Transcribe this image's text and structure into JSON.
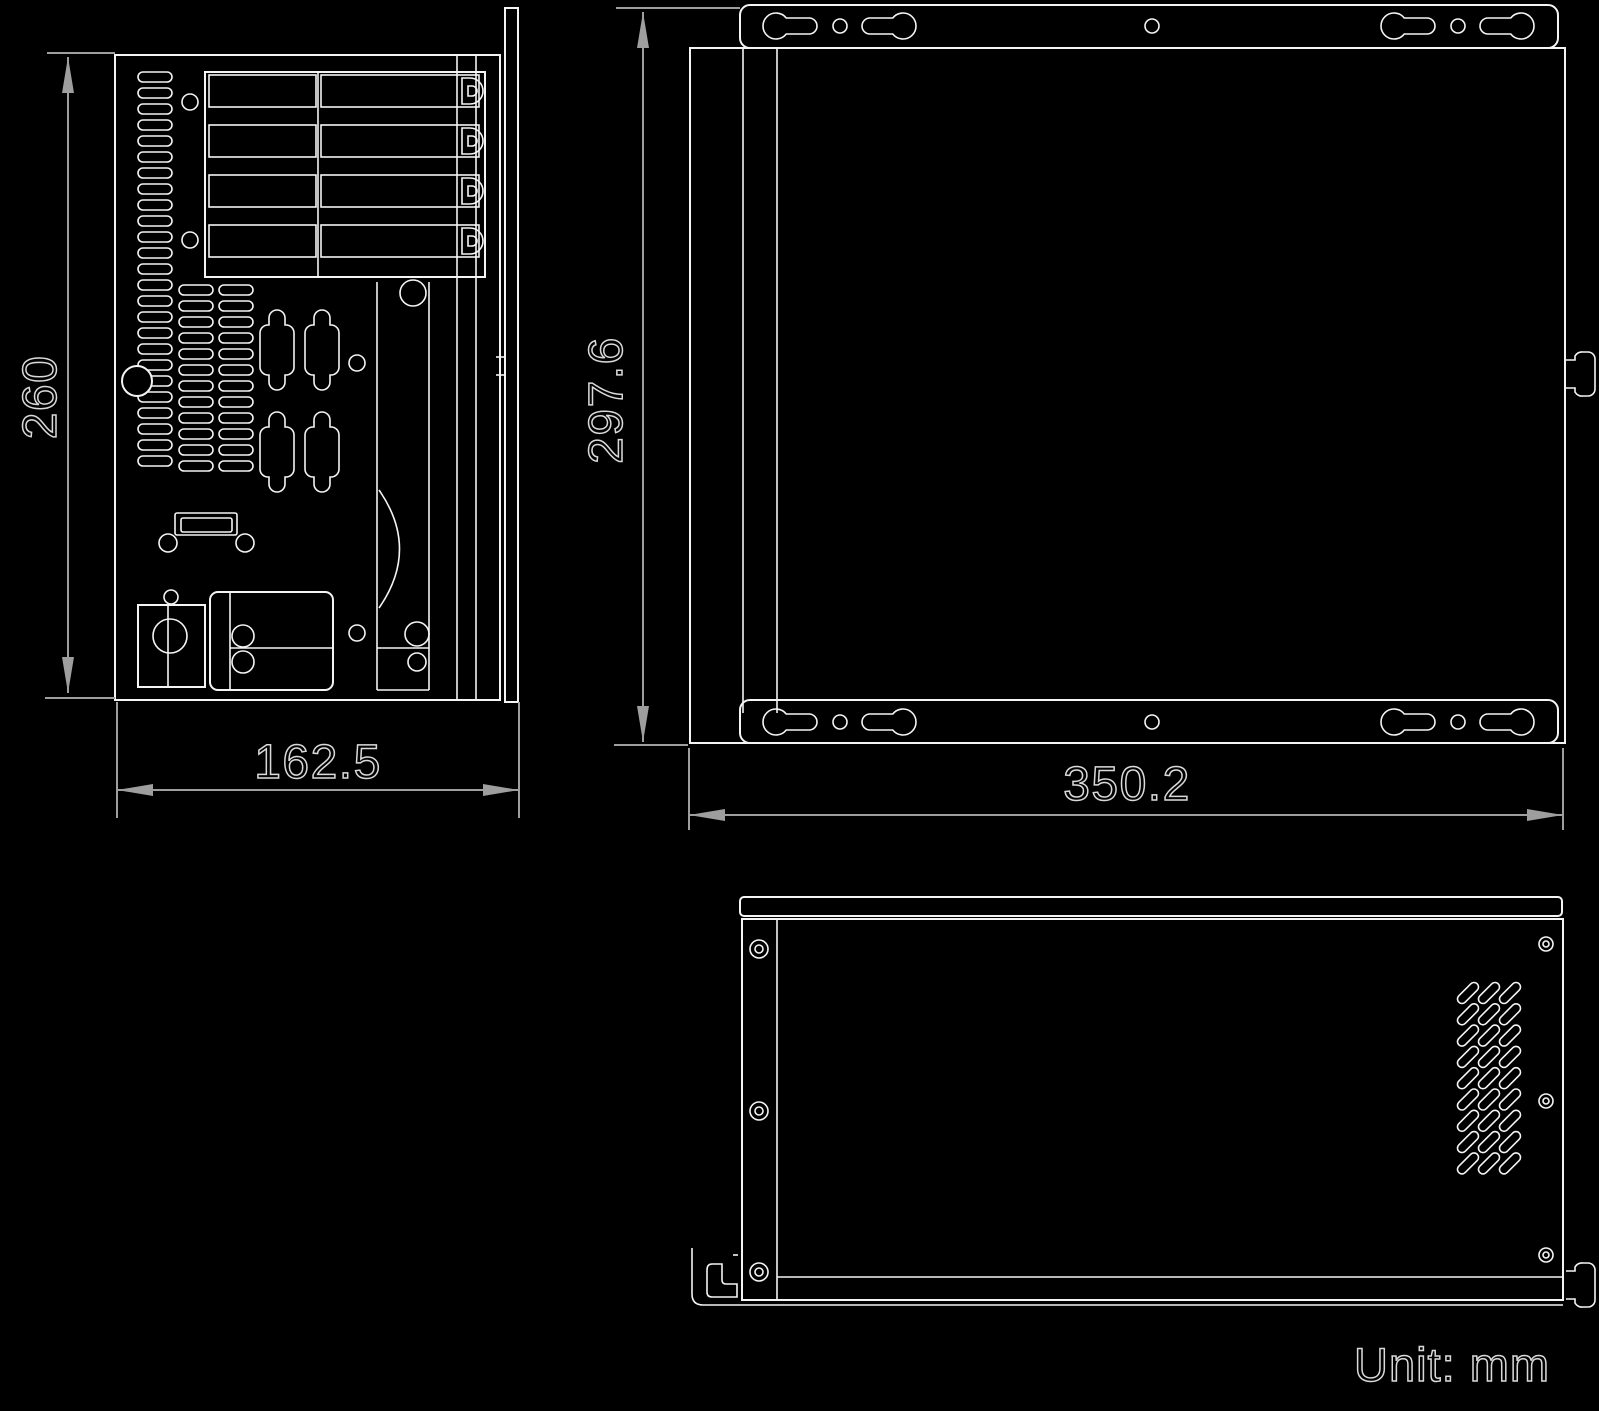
{
  "unit_note": "Unit: mm",
  "dimensions": {
    "rear_view_height_mm": "260",
    "rear_view_width_mm": "162.5",
    "top_view_height_mm": "297.6",
    "top_view_width_mm": "350.2"
  },
  "colors": {
    "background": "#000000",
    "line": "#f4f4f4",
    "dimension_line": "#9e9e9e",
    "text_outline": "#d9d9d9"
  }
}
